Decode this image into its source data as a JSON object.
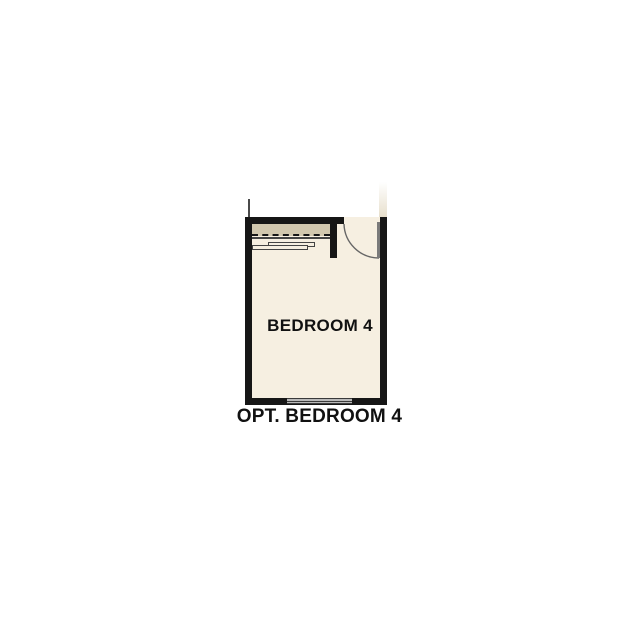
{
  "plan": {
    "room_label": "BEDROOM 4",
    "caption": "OPT. BEDROOM 4"
  },
  "colors": {
    "background": "#ffffff",
    "floor": "#f6efe1",
    "closet": "#d1c7ae",
    "wall": "#161616",
    "thin_line": "#444444",
    "door": "#7a7a7a",
    "swing": "#666666",
    "window_fill": "#b9b9b9",
    "window_line": "#3a3a3a",
    "context_line": "#4a4a4a",
    "remnant": "#e7dfcc",
    "text": "#111111"
  }
}
